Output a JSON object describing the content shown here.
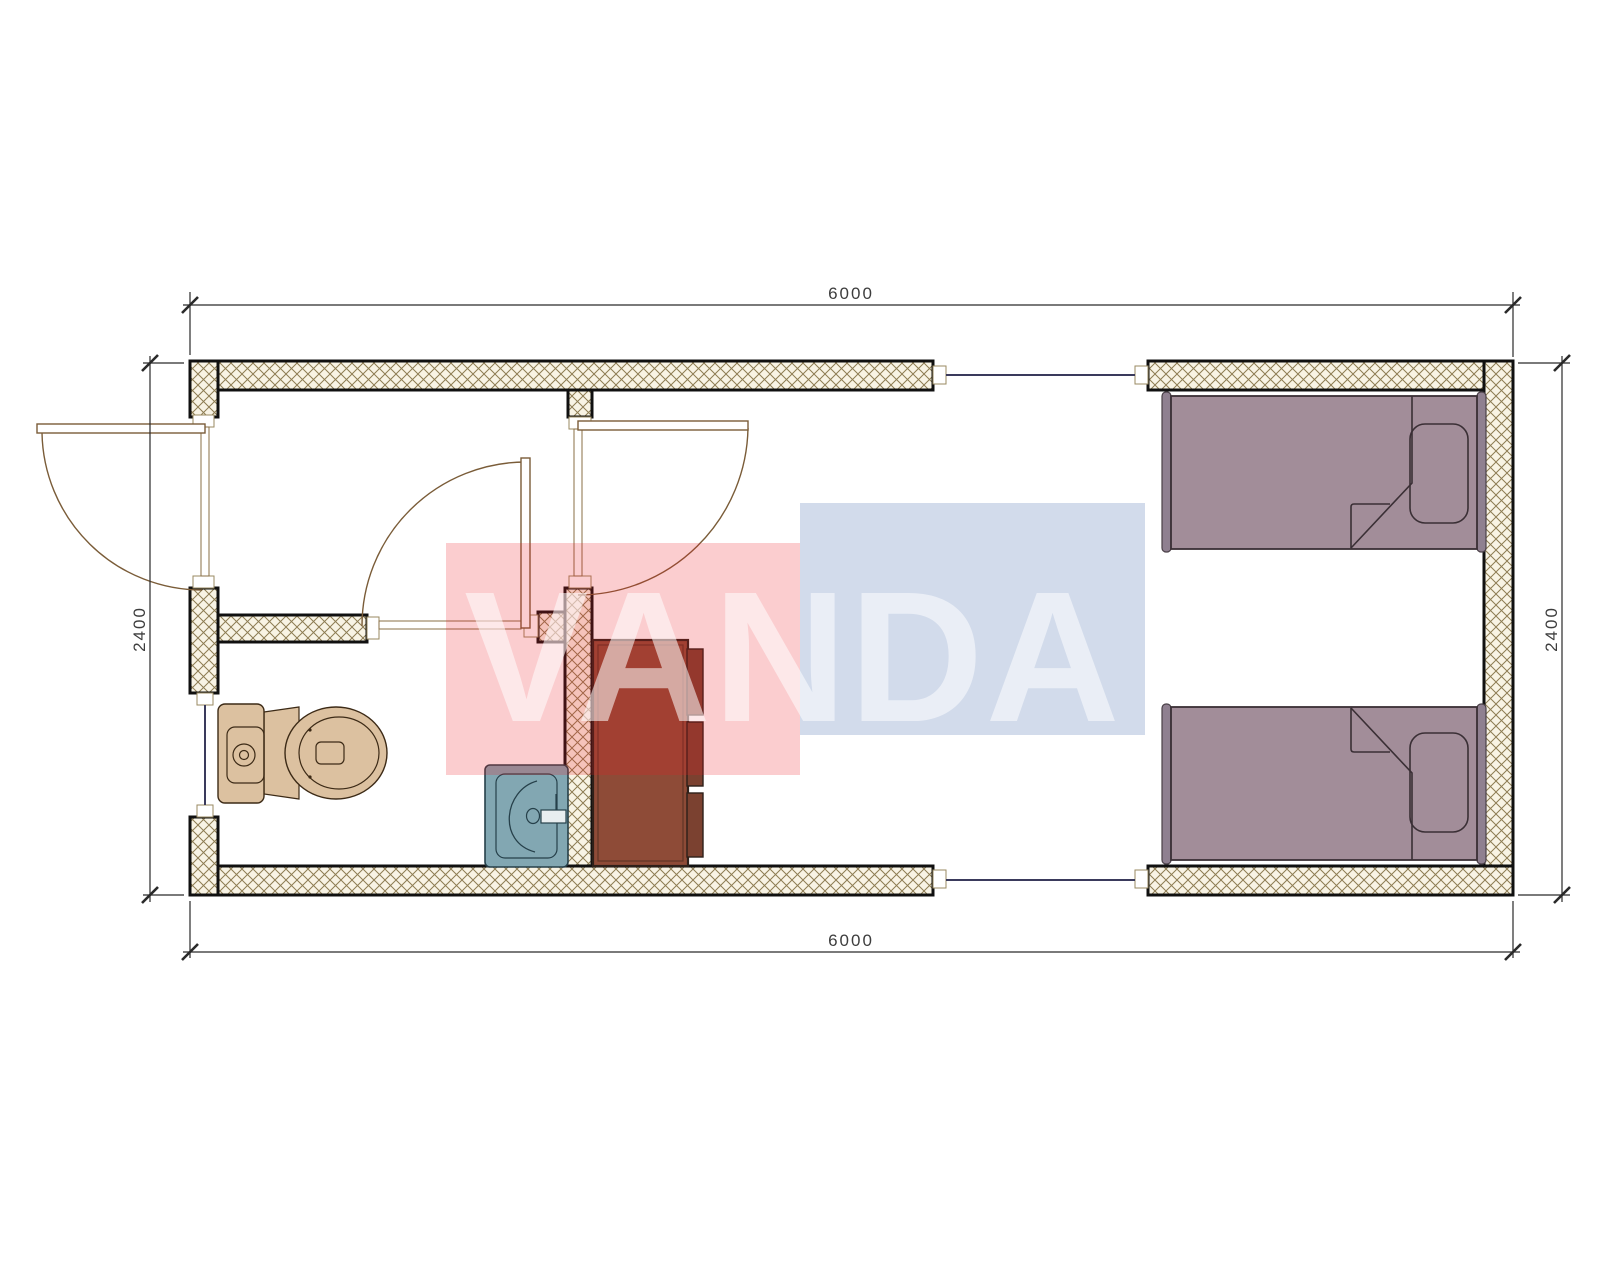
{
  "dimensions": {
    "top": "6000",
    "bottom": "6000",
    "left": "2400",
    "right": "2400"
  },
  "watermark": {
    "text": "VANDA",
    "pink_block_color": "#ED1C24",
    "blue_block_color": "#4A70B0",
    "text_color": "#FFFFFF"
  },
  "palette": {
    "wall_fill": "#f8f3e4",
    "wall_hatch": "#8d7c52",
    "wall_outline": "#101010",
    "door_line": "#7a5c38",
    "window_line": "#3a3a5c",
    "toilet": "#dcc1a0",
    "sink": "#82a7b2",
    "cabinet": "#8e4b37",
    "bed": "#a28d99",
    "dimension_line": "#2a2a2a"
  }
}
